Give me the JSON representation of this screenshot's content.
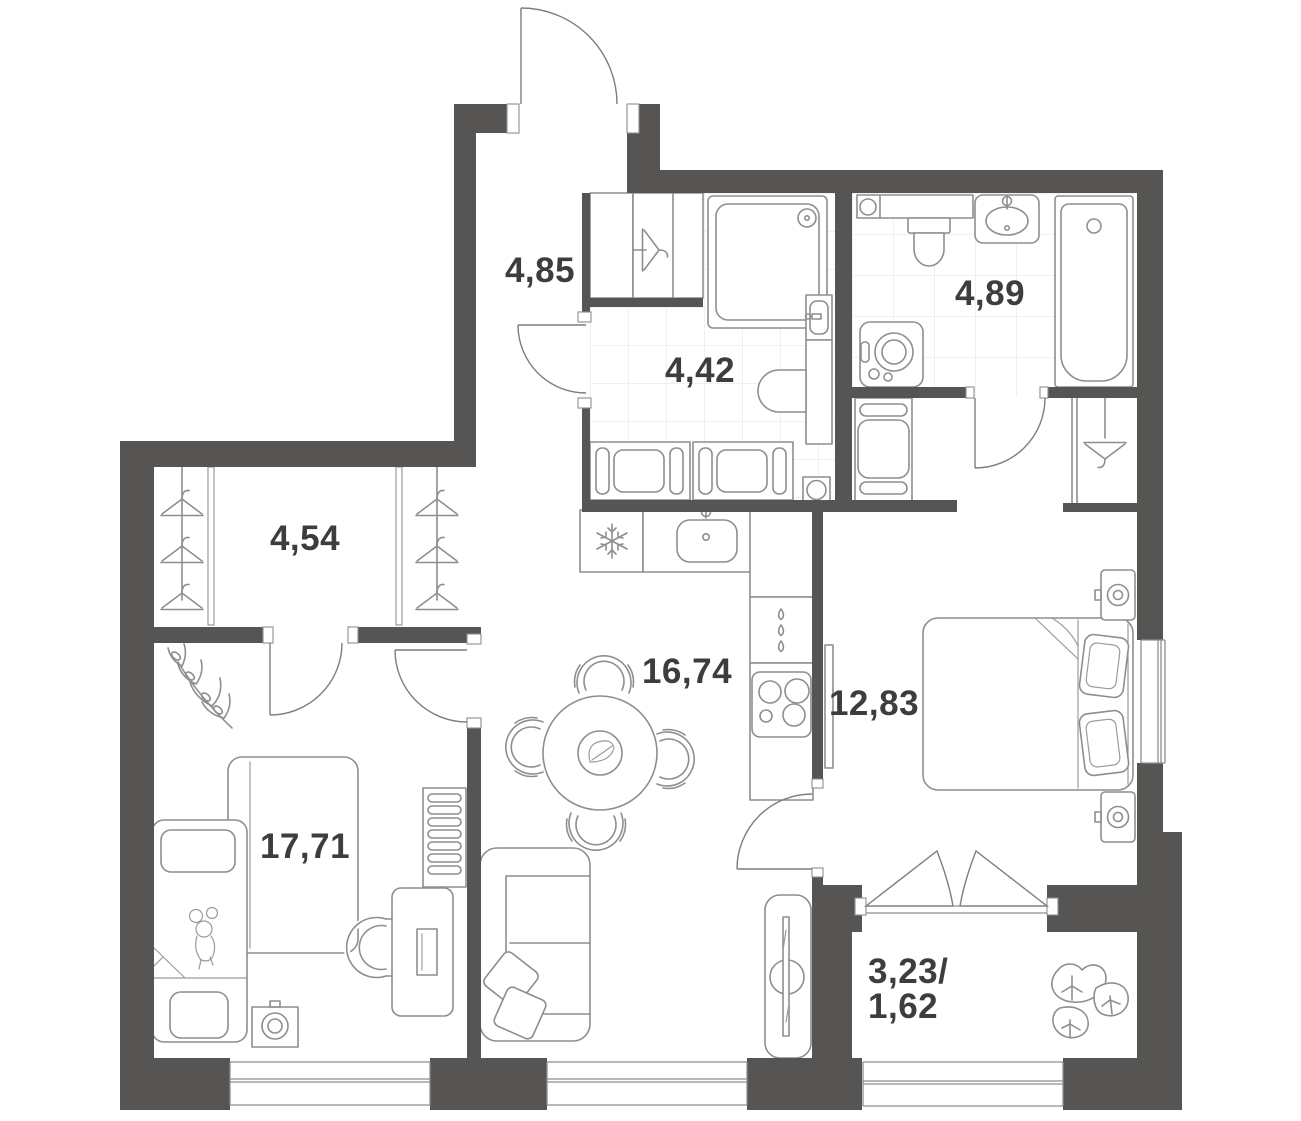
{
  "plan": {
    "type": "apartment-floor-plan",
    "units_note": "room areas in square meters as printed on plan",
    "colors": {
      "wall": "#575553",
      "furniture_line": "#8e8e8e",
      "door_line": "#7d7d7d",
      "tile_grid": "#e6e6e6",
      "label_text": "#3e3d3b",
      "background": "#ffffff"
    },
    "rooms": [
      {
        "id": "hallway",
        "label": "4,85"
      },
      {
        "id": "bathroom-shower",
        "label": "4,42"
      },
      {
        "id": "bathroom-bathtub",
        "label": "4,89"
      },
      {
        "id": "walk-in-wardrobe",
        "label": "4,54"
      },
      {
        "id": "kitchen-living",
        "label": "16,74"
      },
      {
        "id": "kids-bedroom",
        "label": "17,71"
      },
      {
        "id": "master-bedroom",
        "label": "12,83"
      },
      {
        "id": "balcony",
        "label_top": "3,23/",
        "label_bottom": "1,62"
      }
    ],
    "icons": {
      "entrance-door-icon": "quarter-arc swing door at top wall",
      "hanger-icon": "clothes hanger outline (wardrobes and closets)",
      "snowflake-icon": "fridge symbol",
      "shower-icon": "square shower cabin with head",
      "toilet-icon": "toilet bowl outline x2",
      "sink-icon": "washbasin outline x3",
      "bathtub-icon": "bathtub outline",
      "washing-machine-icon": "front-load washer with round door",
      "stove-icon": "4-burner cooktop",
      "dining-table-icon": "round table with 4 chairs",
      "sofa-icon": "two-seat sofa with pillows",
      "tv-icon": "tv panel on media stand",
      "bed-icon": "double bed / single beds with pillows",
      "desk-chair-icon": "desk with monitor and chair",
      "radiator-icon": "wall radiator strips",
      "plant-icon": "potted plants (fern, monstera)",
      "window-icon": "double-glazing window lines"
    }
  }
}
